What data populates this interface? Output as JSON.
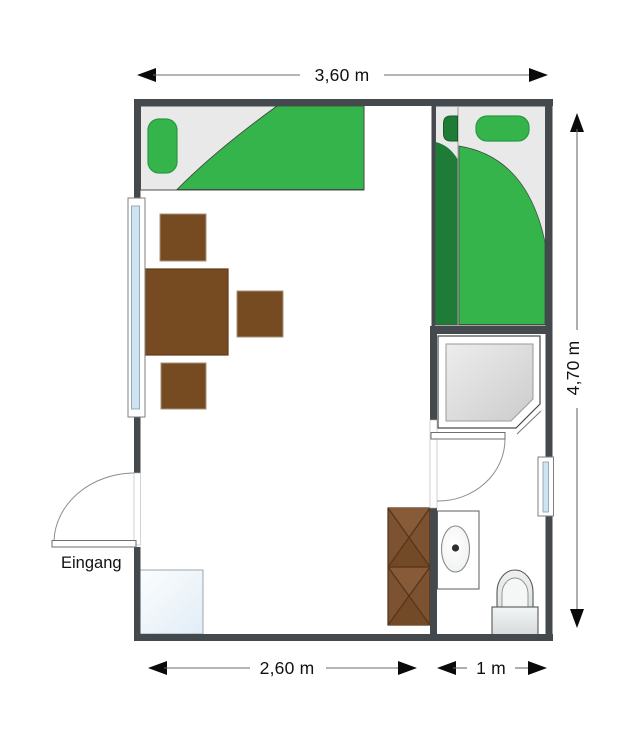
{
  "plan": {
    "type": "floor-plan",
    "dims": {
      "top": "3,60 m",
      "right": "4,70 m",
      "bottom_main": "2,60 m",
      "bottom_bath": "1 m"
    },
    "labels": {
      "entrance": "Eingang"
    },
    "colors": {
      "wall": "#43494c",
      "bed_green": "#35b44b",
      "bed_green_dark": "#1e7c36",
      "bed_frame": "#e9e9e9",
      "wood_brown": "#764b22",
      "wardrobe_brown": "#7d5232",
      "glass_blue": "#cfe4f3",
      "fixture_gray": "#dcdfe0",
      "dimension_text": "#111111"
    }
  }
}
